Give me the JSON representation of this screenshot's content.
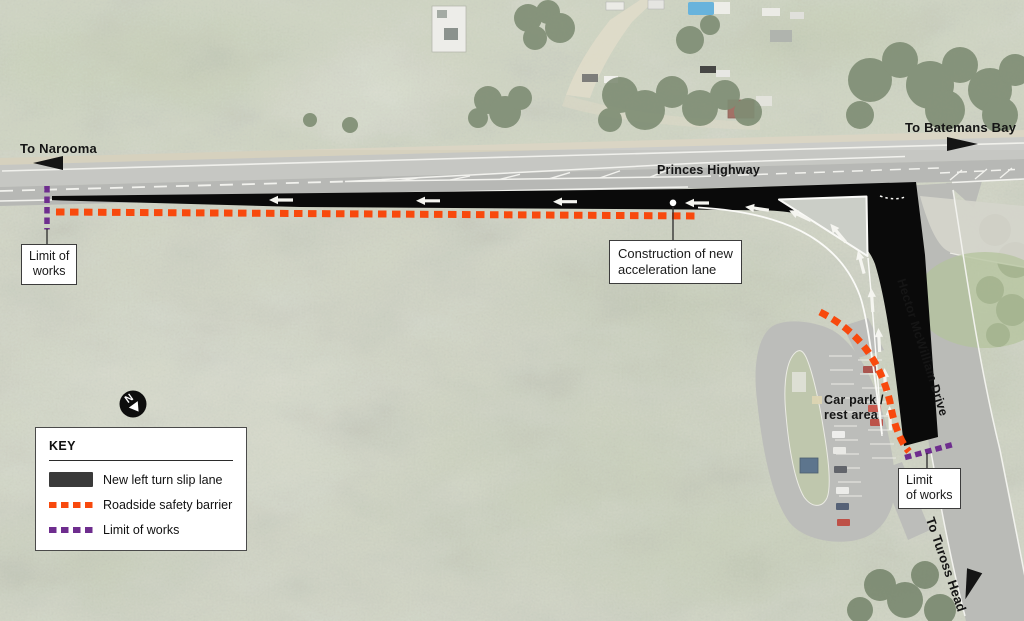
{
  "map": {
    "destination_labels": {
      "to_narooma": "To Narooma",
      "to_batemans_bay": "To Batemans Bay",
      "to_tuross_head": "To Tuross Head"
    },
    "road_labels": {
      "princes_highway": "Princes Highway",
      "hector_mcwilliam_drive": "Hector McWilliam Drive"
    },
    "area_labels": {
      "car_park_line1": "Car park /",
      "car_park_line2": "rest area"
    },
    "north_arrow": {
      "label": "N"
    },
    "callouts": {
      "limit_of_works_west": {
        "line1": "Limit of",
        "line2": "works"
      },
      "limit_of_works_south": {
        "line1": "Limit",
        "line2": "of works"
      },
      "construction": {
        "line1": "Construction of new",
        "line2": "acceleration lane"
      }
    }
  },
  "key": {
    "title": "KEY",
    "items": [
      {
        "label": "New left turn slip lane",
        "swatch": "solid",
        "color": "#3a3a3a"
      },
      {
        "label": "Roadside safety barrier",
        "swatch": "dashed",
        "color": "#f8490d"
      },
      {
        "label": "Limit of works",
        "swatch": "dashed",
        "color": "#6e2d8e"
      }
    ]
  },
  "colors": {
    "new_slip_lane_overlay": "#0a0a0a",
    "roadside_safety_barrier": "#f8490d",
    "limit_of_works": "#6e2d8e",
    "traffic_island": "#cbcec7"
  }
}
